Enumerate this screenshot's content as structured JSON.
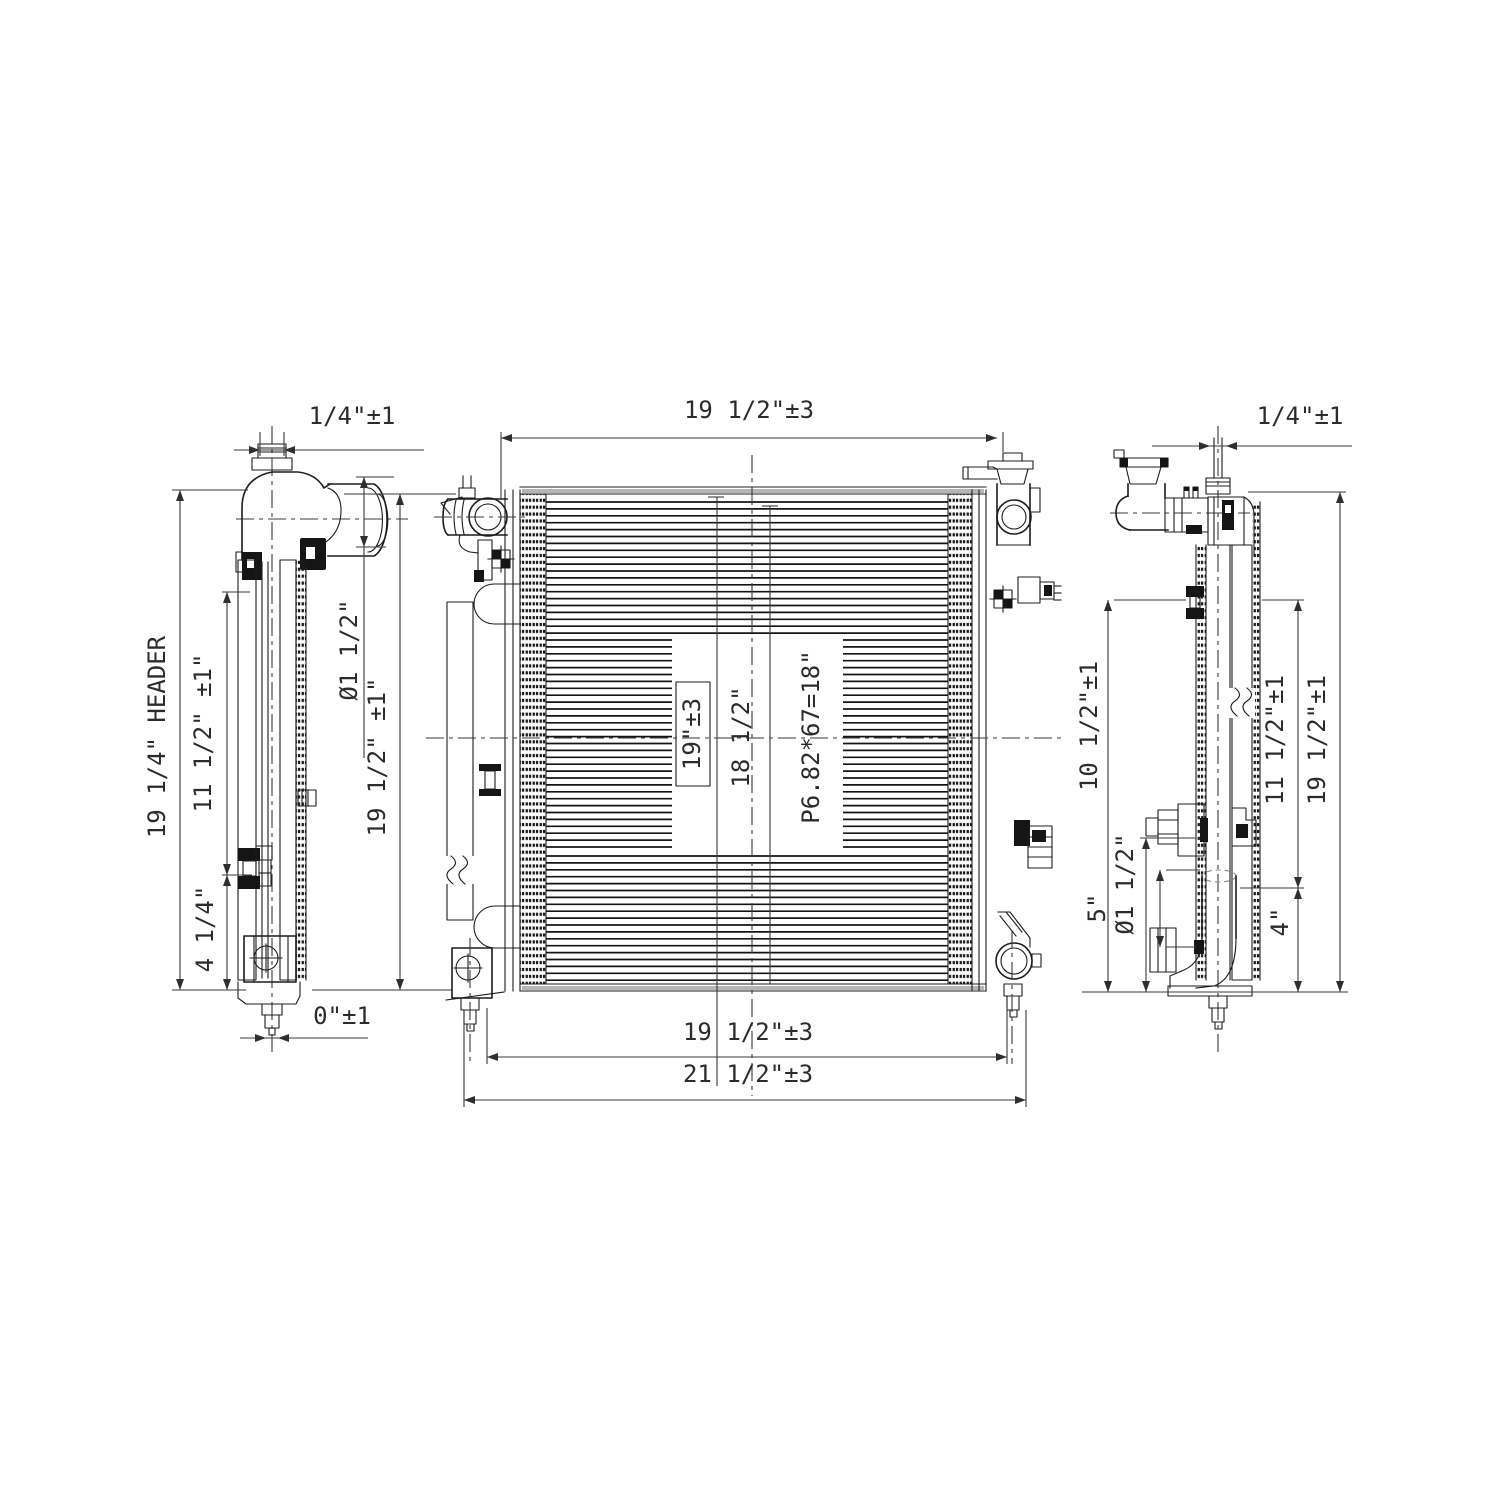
{
  "page": {
    "background": "#ffffff",
    "ink_color": "#1c1c1c",
    "text_color": "#2b2b2b"
  },
  "drawing": {
    "views": {
      "left_view": {
        "dims": {
          "top_offset": "1/4\"±1",
          "header_height": "19 1/4\" HEADER",
          "upper_span": "11 1/2\" ±1\"",
          "lower_span": "4 1/4\"",
          "inlet_diameter": "Ø1 1/2\"",
          "overall_height": "19 1/2\" ±1\"",
          "bottom_offset": "0\"±1"
        }
      },
      "front_view": {
        "dims": {
          "top_width": "19 1/2\"±3",
          "core_width": "19\"±3",
          "tank_span": "18 1/2\"",
          "fin_spec": "P6.82*67=18\"",
          "bottom_width": "19 1/2\"±3",
          "overall_width": "21 1/2\"±3"
        }
      },
      "right_view": {
        "dims": {
          "top_offset": "1/4\"±1",
          "left_upper_span": "10 1/2\"±1",
          "left_lower_span": "5\"",
          "outlet_diameter": "Ø1 1/2\"",
          "right_upper_span": "11 1/2\"±1",
          "right_lower_span": "4\"",
          "overall_height": "19 1/2\"±1"
        }
      }
    }
  }
}
